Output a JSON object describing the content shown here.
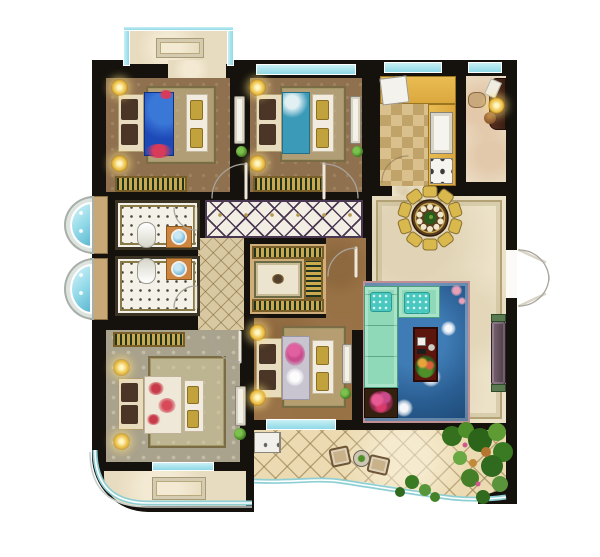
{
  "meta": {
    "type": "residential-floor-plan",
    "width": 600,
    "height": 557,
    "visible_text": "none"
  },
  "colors": {
    "wall": "#15120d",
    "floorBrown": "#8f7150",
    "floorWood": "#997247",
    "carpet": "#a9a28c",
    "marble": "#ece2c8",
    "marbleFrame": "#b3a276",
    "corridorTile": "#f2eee4",
    "corridorLine": "#4a3752",
    "goldDot": "#b59a50",
    "hallTile": "#d9c9a2",
    "terraceTile": "#ecdbb2",
    "balconyFloor": "#e8dcc0",
    "kitchenCounter": "#dca83e",
    "checkerA": "#d9c08c",
    "checkerB": "#c0a368",
    "bathFloor": "#f4f1e8",
    "bathBorder": "#3c3424",
    "sinkCounter": "#cd8540",
    "basin": "#7ab8d8",
    "glass": "#8fd8e8",
    "glassLight": "#c8f0f4",
    "lampGold": "#e8b93a",
    "bedHead": "#e8dcc0",
    "pillow": "#4a3526",
    "bench": "#f2ece0",
    "benchCushion": "#c2a23c",
    "duvetBlue": "#1e4ab8",
    "duvetTeal": "#3a9ab8",
    "duvetCream": "#efe8d8",
    "duvetLilac": "#c8c4d0",
    "flowerRed": "#d83a5a",
    "flowerPink": "#c84a8a",
    "rugBlue": "#2a5e92",
    "rugBorder": "#bf8f93",
    "sofa": "#8fd8b8",
    "sofaEdge": "#4aa07c",
    "cushionTeal": "#49c8c0",
    "tableRed": "#5c160e",
    "tvConsole": "#6a5560",
    "planter": "#33200f",
    "wardrobeGold": "#caa84e",
    "wardrobeGreen": "#1e3320",
    "desk": "#3a1f14",
    "plantGreen": "#4e8f2a",
    "diningChair": "#d9b94e",
    "diningTable": "#5c3d1e"
  },
  "rooms": [
    {
      "name": "balcony-top",
      "items": [
        "floor-mat",
        "glass-railing"
      ]
    },
    {
      "name": "bedroom-top-left",
      "items": [
        "double-bed-blue",
        "foot-bench",
        "wall-lamp",
        "wall-lamp",
        "wardrobe",
        "dresser",
        "plant"
      ]
    },
    {
      "name": "bedroom-top-middle",
      "items": [
        "double-bed-teal",
        "foot-bench",
        "wall-lamp",
        "wall-lamp",
        "wardrobe",
        "dresser",
        "plant"
      ]
    },
    {
      "name": "kitchen",
      "items": [
        "fridge",
        "l-counter",
        "double-sink",
        "stove"
      ]
    },
    {
      "name": "study",
      "items": [
        "desk",
        "chair",
        "desk-lamp",
        "vase"
      ]
    },
    {
      "name": "dining-room",
      "items": [
        "round-table",
        "ten-chairs",
        "centerpiece-plant"
      ]
    },
    {
      "name": "living-room",
      "items": [
        "corner-sofa",
        "coffee-table",
        "floral-rug",
        "tv-console",
        "flower-planter"
      ]
    },
    {
      "name": "corridor",
      "items": []
    },
    {
      "name": "hallway",
      "items": []
    },
    {
      "name": "walk-in-closet",
      "items": [
        "wardrobe",
        "wardrobe",
        "wardrobe",
        "rug"
      ]
    },
    {
      "name": "bathroom-upper",
      "items": [
        "toilet",
        "sink"
      ]
    },
    {
      "name": "bathroom-lower",
      "items": [
        "toilet",
        "sink"
      ]
    },
    {
      "name": "bay-window-upper",
      "items": []
    },
    {
      "name": "bay-window-lower",
      "items": []
    },
    {
      "name": "bedroom-bottom-left",
      "items": [
        "double-bed-floral",
        "foot-bench",
        "wall-lamp",
        "wall-lamp",
        "wardrobe",
        "dresser",
        "plant"
      ]
    },
    {
      "name": "bedroom-bottom-middle",
      "items": [
        "double-bed-lilac",
        "foot-bench",
        "wall-lamp",
        "wall-lamp",
        "dresser",
        "plant"
      ]
    },
    {
      "name": "balcony-bottom-left",
      "items": [
        "floor-mat",
        "curved-glass-railing"
      ]
    },
    {
      "name": "terrace",
      "items": [
        "washing-machine",
        "chair",
        "chair",
        "tea-table",
        "garden-plants",
        "wavy-glass-railing"
      ]
    },
    {
      "name": "entry",
      "items": [
        "double-door"
      ]
    }
  ]
}
